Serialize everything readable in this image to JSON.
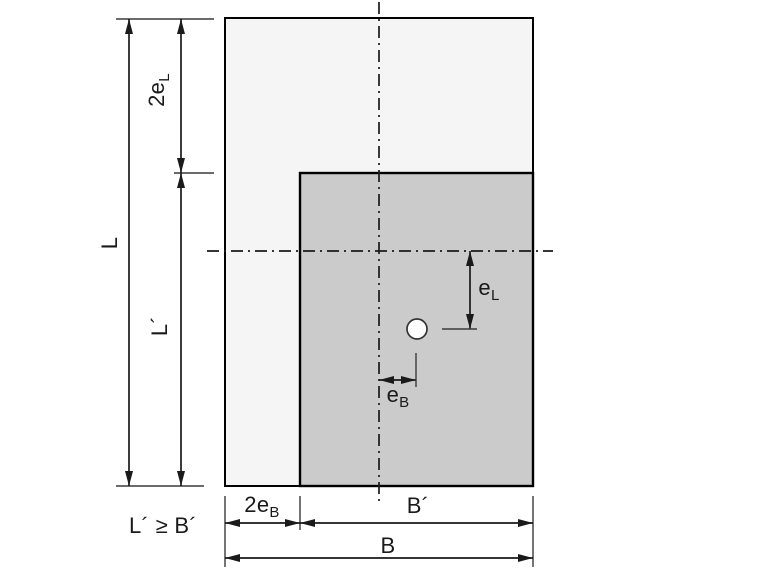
{
  "diagram": {
    "labels": {
      "L": "L",
      "two_eL": {
        "main": "2e",
        "sub": "L"
      },
      "L_prime": "L´",
      "e_L": {
        "main": "e",
        "sub": "L"
      },
      "e_B": {
        "main": "e",
        "sub": "B"
      },
      "two_eB": {
        "main": "2e",
        "sub": "B"
      },
      "B_prime": "B´",
      "B": "B",
      "constraint": "L´ ≥ B´"
    },
    "colors": {
      "foundation_fill": "#f5f5f5",
      "effective_area_fill": "#cbcbcb",
      "load_point_fill": "#ffffff",
      "line": "#1a1a1a",
      "background": "#ffffff"
    }
  }
}
